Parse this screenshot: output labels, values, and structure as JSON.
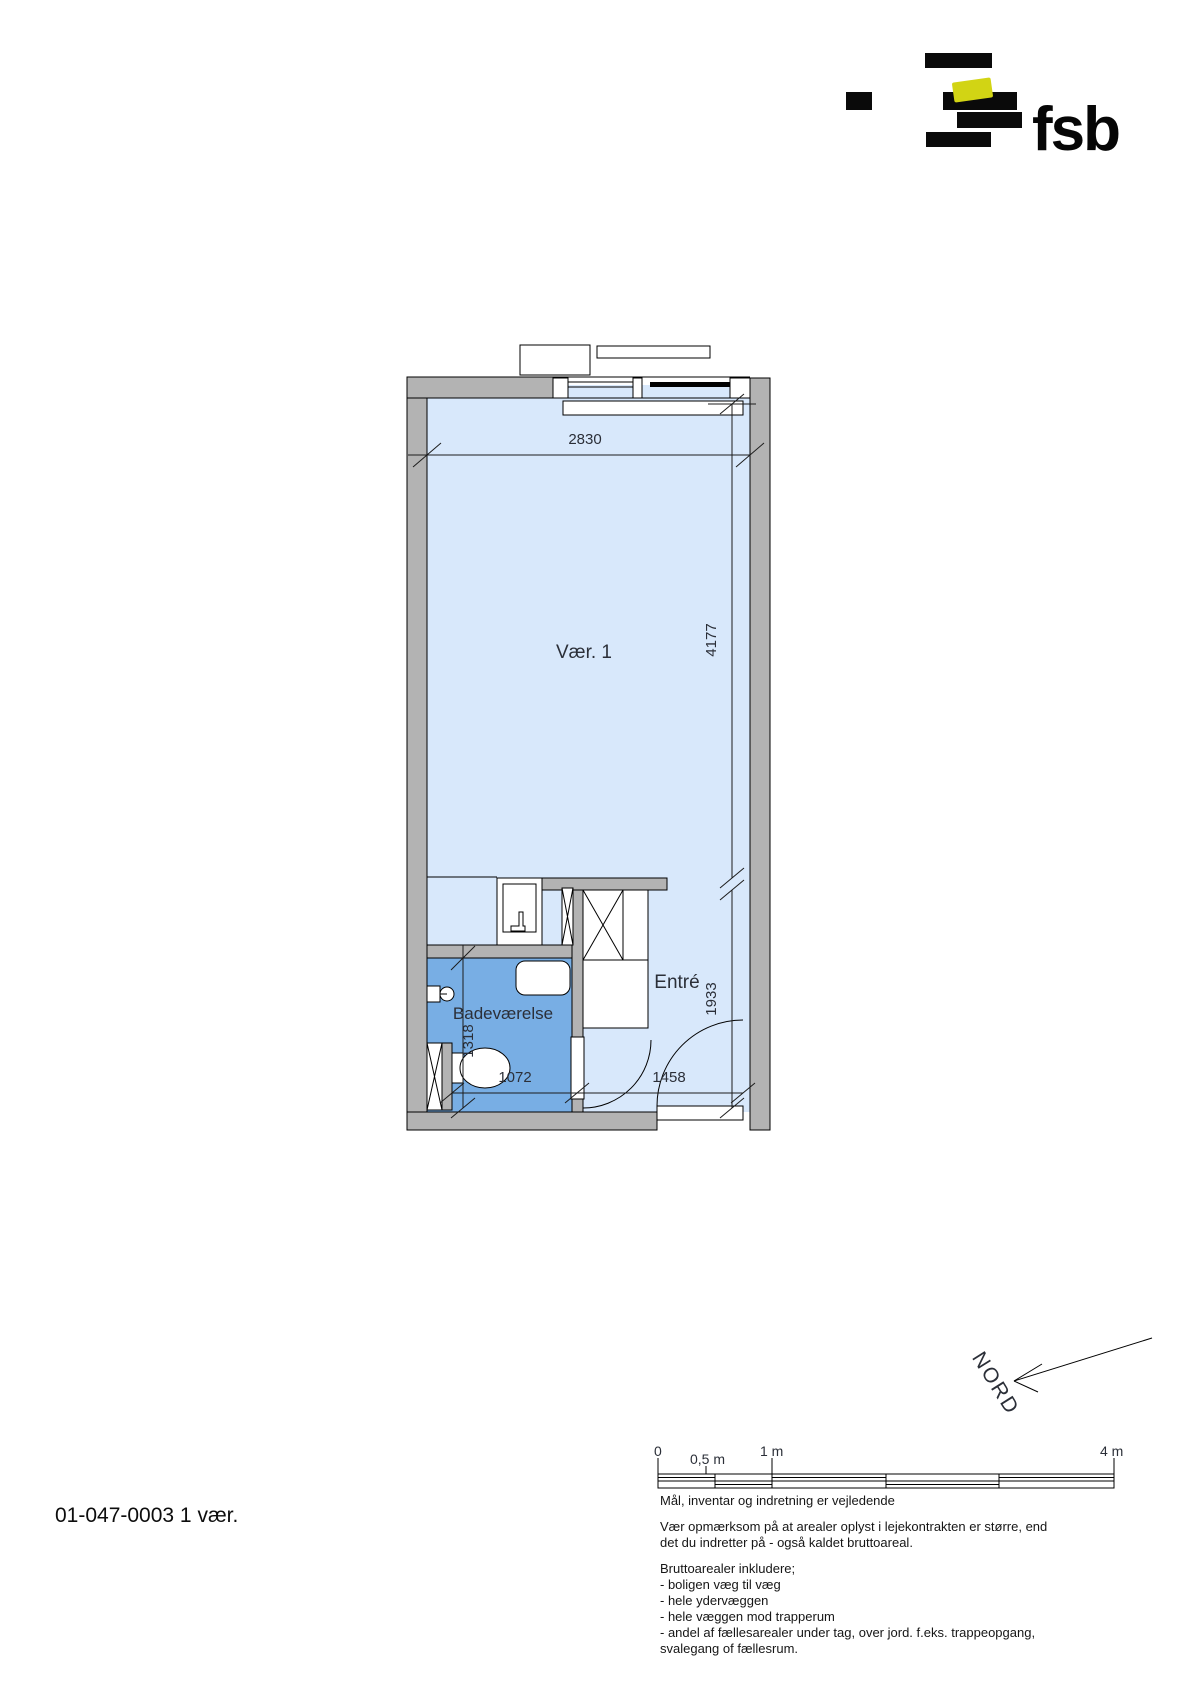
{
  "logo": {
    "brand": "fsb",
    "accent_yellow": "#d2d414",
    "block_color": "#0a0a0a"
  },
  "plan": {
    "labels": {
      "room": "Vær. 1",
      "bathroom": "Badeværelse",
      "entry": "Entré"
    },
    "dimensions": {
      "room_width": "2830",
      "room_depth": "4177",
      "entry_depth": "1933",
      "bathroom_depth": "1318",
      "bathroom_width": "1072",
      "entry_width": "1458"
    },
    "colors": {
      "room_fill": "#d8e8fb",
      "bathroom_fill": "#78aee4",
      "wall_gray": "#b3b3b3"
    }
  },
  "compass": {
    "label": "NORD"
  },
  "scalebar": {
    "labels": [
      "0",
      "0,5 m",
      "1 m",
      "4 m"
    ]
  },
  "notes": {
    "line1": "Mål, inventar og indretning er vejledende",
    "para1a": "Vær opmærksom på at arealer oplyst i lejekontrakten er større, end",
    "para1b": "det du indretter på - også kaldet bruttoareal.",
    "para2_title": "Bruttoarealer inkludere;",
    "bullet1": "- boligen væg til væg",
    "bullet2": "- hele ydervæggen",
    "bullet3": "- hele væggen mod trapperum",
    "bullet4": "- andel af fællesarealer under tag, over jord. f.eks. trappeopgang,",
    "bullet5": "svalegang of fællesrum."
  },
  "footer": {
    "plan_id": "01-047-0003 1 vær."
  }
}
